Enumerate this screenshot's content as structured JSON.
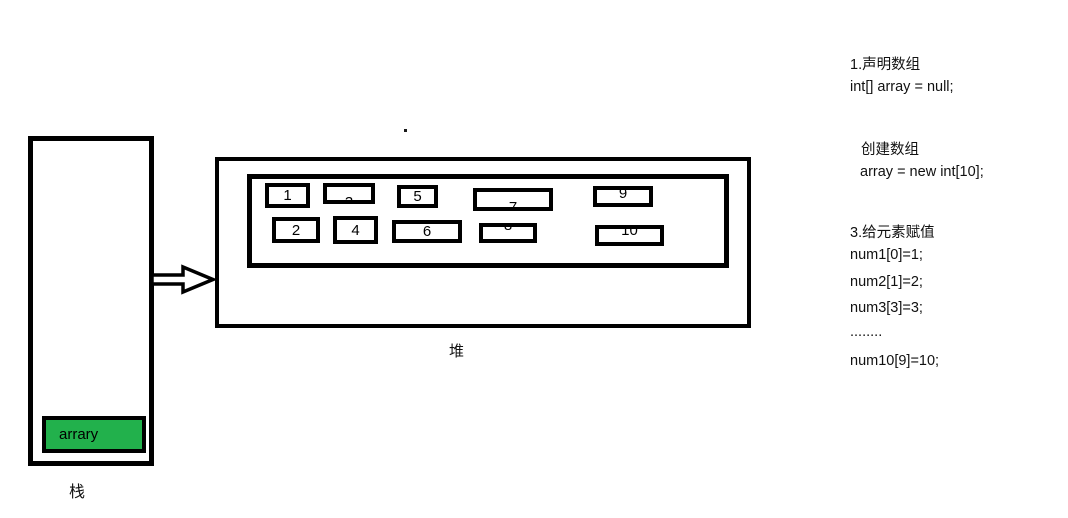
{
  "diagram": {
    "stack": {
      "label": "栈",
      "variable": "arrary"
    },
    "heap": {
      "label": "堆",
      "cells": [
        "1",
        "2",
        "3",
        "4",
        "5",
        "6",
        "7",
        "8",
        "9",
        "10"
      ]
    },
    "colors": {
      "variable_fill": "#22B14C",
      "stroke": "#000000",
      "background": "#FFFFFF"
    }
  },
  "notes": {
    "lines": [
      "1.声明数组",
      "int[] array = null;",
      "创建数组",
      "array = new int[10];",
      "3.给元素赋值",
      "num1[0]=1;",
      "num2[1]=2;",
      "num3[3]=3;",
      "........",
      "num10[9]=10;"
    ]
  }
}
